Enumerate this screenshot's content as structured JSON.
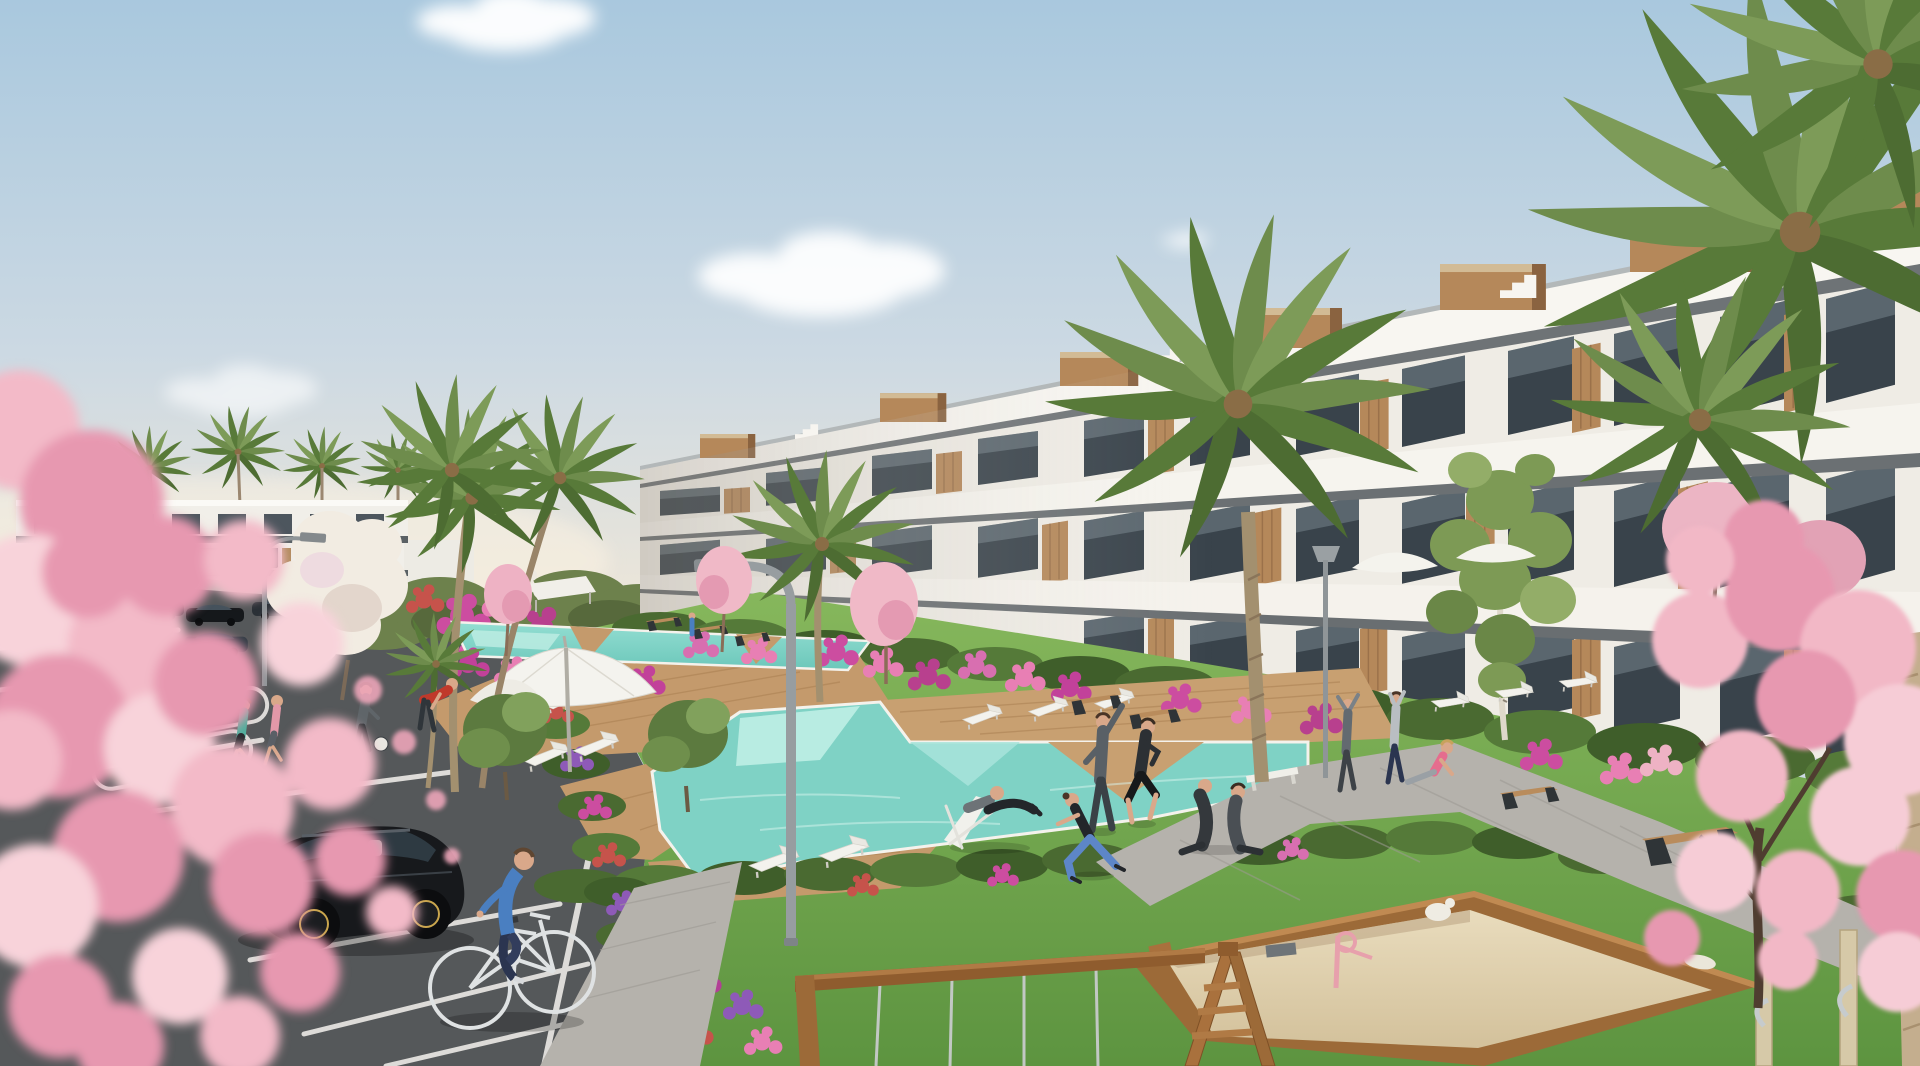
{
  "scene": {
    "title": "New-build residential complex - exterior visualization",
    "type": "3D architectural render",
    "time_of_day": "daytime, clear sky with light clouds",
    "setting": "Mediterranean apartment complex with communal pools, lawns, parking lot and playground"
  },
  "palette": {
    "sky_top": "#a9c8de",
    "sky_mid": "#ccd9e3",
    "sky_horizon": "#f1e8d8",
    "cloud_white": "#ffffff",
    "building_white": "#efece5",
    "band_white": "#f8f6f1",
    "band_dark": "#6e7376",
    "glass_dark": "#39434b",
    "wood_accent": "#b5885a",
    "far_building_white": "#f1efe9",
    "grass_light": "#86b75c",
    "grass_dark": "#5d9440",
    "hedge_green": "#4a6a31",
    "palm_green": "#6e8c4c",
    "palm_dark": "#587a39",
    "trunk_brown": "#a3906f",
    "pool_main": "#7fd2c5",
    "pool_light": "#bfeee4",
    "deck_wood": "#c49a6c",
    "paver_gray": "#b5b2ac",
    "asphalt_dark": "#55585a",
    "line_white": "#eceae6",
    "sand_tan": "#e4d5b2",
    "frame_wood": "#9c6a38",
    "blossom_pink": "#f2b8c6",
    "blossom_deep": "#e798b0",
    "flower_magenta": "#c2419a",
    "flower_red": "#c6534b",
    "flower_purple": "#8e5ab8",
    "car_black": "#17191c",
    "lamp_gray": "#979da0",
    "skin": "#d9a88a",
    "outfit_blue": "#4a7fc1",
    "outfit_teal": "#4fae9c",
    "outfit_pink": "#e56d8e",
    "outfit_red": "#c0392b"
  },
  "elements": {
    "buildings": [
      {
        "id": "main-apartment-block",
        "floors": 3,
        "style": "white terraced block, wood-slat accents, glass balconies, rooftop wood volumes, roof stairs"
      },
      {
        "id": "left-apartment-block",
        "floors": 2,
        "style": "distant white linear block with dark window bands"
      }
    ],
    "pools": [
      {
        "id": "upper-lap-pool",
        "shape": "long strip with wood wedges"
      },
      {
        "id": "main-pool",
        "shape": "large angular pool with wood peninsula and pale shelves"
      }
    ],
    "vegetation": {
      "palm_trees": 10,
      "pink_blossom_trees": 6,
      "white_flowering_tree": 1,
      "green_trees": 4,
      "hedge_rows": 4,
      "flower_beds": "pink, magenta, red, purple and white clusters"
    },
    "amenities": {
      "parasols": 3,
      "white_canopies": 2,
      "sun_loungers": 12,
      "benches": 7,
      "street_lamps": 3,
      "sandbox": 1,
      "swing_frame_with_cables": 1,
      "playground_posts": 2,
      "parking_lot": 1
    },
    "vehicles": {
      "black_hatchback_foreground": 1,
      "parked_dark_cars": 7
    },
    "people": [
      {
        "id": "cyclist",
        "desc": "man in blue sweater on white bicycle"
      },
      {
        "id": "reclining-man",
        "desc": "man on white deck chair beside main pool"
      },
      {
        "id": "stretching-man",
        "desc": "man in grey sportswear stretching on lawn"
      },
      {
        "id": "jogging-man",
        "desc": "man in black running on lawn"
      },
      {
        "id": "yoga-woman",
        "desc": "woman in blue leggings lunging"
      },
      {
        "id": "seated-couple",
        "desc": "couple sitting on the grass"
      },
      {
        "id": "stretching-pair",
        "desc": "two people with raised arms on the path"
      },
      {
        "id": "seated-woman-pink",
        "desc": "woman in pink top sitting on path"
      },
      {
        "id": "jogger-teal",
        "desc": "woman in teal top jogging near parking"
      },
      {
        "id": "jogger-pink",
        "desc": "woman in pink top jogging near parking"
      },
      {
        "id": "man-with-football",
        "desc": "man in grey with white ball"
      },
      {
        "id": "man-red-shirt",
        "desc": "man in red shirt bending over flower bed"
      },
      {
        "id": "distant-walker",
        "desc": "tiny figure in blue near upper pool"
      }
    ]
  }
}
